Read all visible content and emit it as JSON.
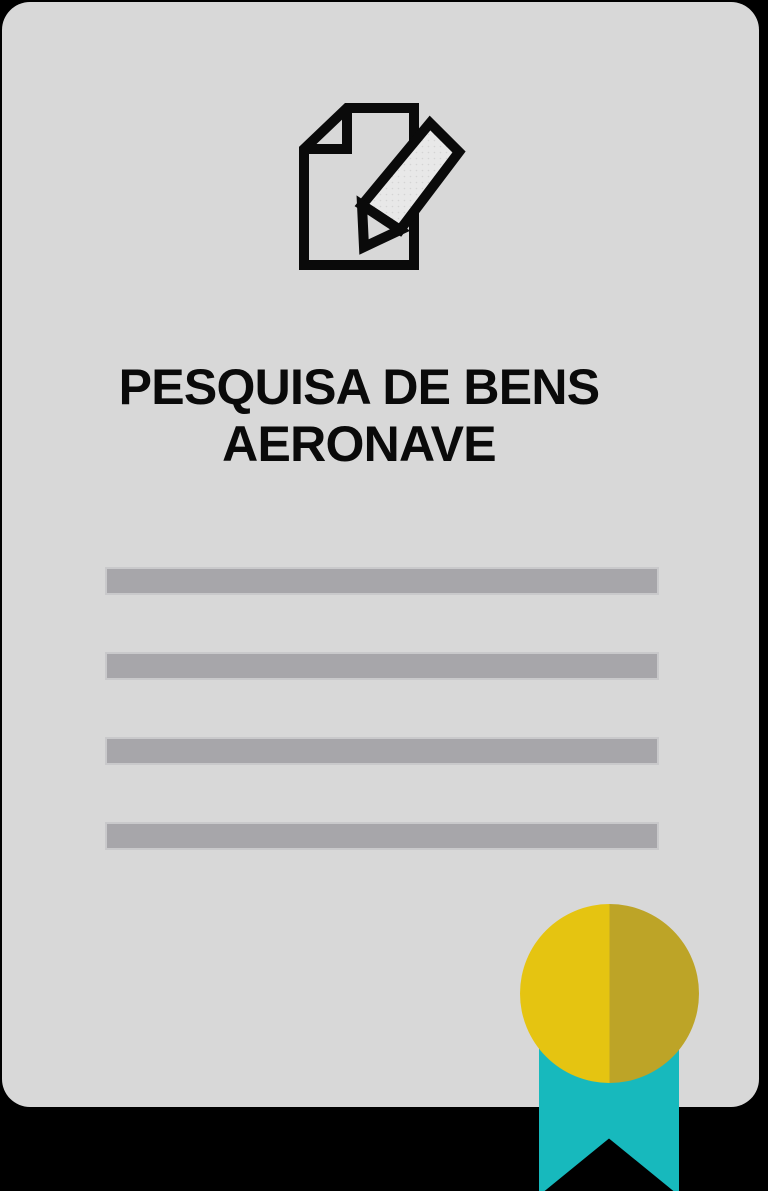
{
  "card": {
    "title_line1": "PESQUISA DE BENS",
    "title_line2": "AERONAVE",
    "title_full": "PESQUISA DE BENS AERONAVE"
  },
  "icons": {
    "header_icon": "document-edit-icon",
    "badge_icon": "award-medal-icon"
  },
  "placeholder_lines": [
    "",
    "",
    "",
    ""
  ],
  "colors": {
    "background": "#000000",
    "card_bg": "#d8d8d8",
    "bar_fill": "#a7a6aa",
    "bar_edge": "#c9c9cb",
    "ink": "#0a0a0a",
    "pencil_fill": "#e8e8e8",
    "pencil_dot": "#d4d4d4",
    "medal_gold_light": "#e5c411",
    "medal_gold_dark": "#bda427",
    "ribbon_teal": "#17b9bd"
  }
}
